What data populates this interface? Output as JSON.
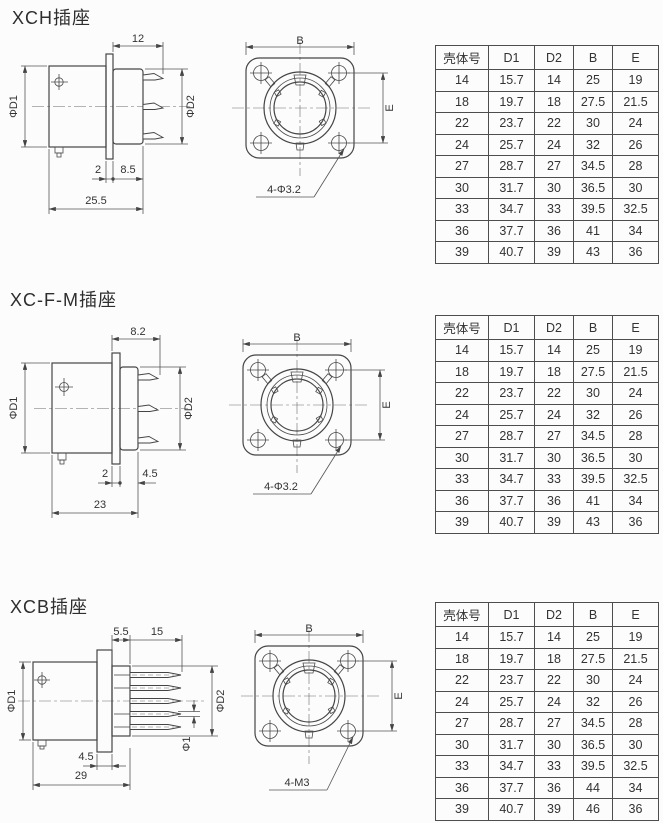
{
  "sections": [
    {
      "title": "XCH插座",
      "side": {
        "top": "12",
        "left": "ΦD1",
        "right": "ΦD2",
        "a": "2",
        "b": "8.5",
        "total": "25.5"
      },
      "front": {
        "width": "B",
        "height": "E",
        "holes": "4-Φ3.2"
      },
      "table": {
        "headers": [
          "壳体号",
          "D1",
          "D2",
          "B",
          "E"
        ],
        "rows": [
          [
            "14",
            "15.7",
            "14",
            "25",
            "19"
          ],
          [
            "18",
            "19.7",
            "18",
            "27.5",
            "21.5"
          ],
          [
            "22",
            "23.7",
            "22",
            "30",
            "24"
          ],
          [
            "24",
            "25.7",
            "24",
            "32",
            "26"
          ],
          [
            "27",
            "28.7",
            "27",
            "34.5",
            "28"
          ],
          [
            "30",
            "31.7",
            "30",
            "36.5",
            "30"
          ],
          [
            "33",
            "34.7",
            "33",
            "39.5",
            "32.5"
          ],
          [
            "36",
            "37.7",
            "36",
            "41",
            "34"
          ],
          [
            "39",
            "40.7",
            "39",
            "43",
            "36"
          ]
        ]
      }
    },
    {
      "title": "XC-F-M插座",
      "side": {
        "top": "8.2",
        "left": "ΦD1",
        "right": "ΦD2",
        "a": "2",
        "b": "4.5",
        "total": "23"
      },
      "front": {
        "width": "B",
        "height": "E",
        "holes": "4-Φ3.2"
      },
      "table": {
        "headers": [
          "壳体号",
          "D1",
          "D2",
          "B",
          "E"
        ],
        "rows": [
          [
            "14",
            "15.7",
            "14",
            "25",
            "19"
          ],
          [
            "18",
            "19.7",
            "18",
            "27.5",
            "21.5"
          ],
          [
            "22",
            "23.7",
            "22",
            "30",
            "24"
          ],
          [
            "24",
            "25.7",
            "24",
            "32",
            "26"
          ],
          [
            "27",
            "28.7",
            "27",
            "34.5",
            "28"
          ],
          [
            "30",
            "31.7",
            "30",
            "36.5",
            "30"
          ],
          [
            "33",
            "34.7",
            "33",
            "39.5",
            "32.5"
          ],
          [
            "36",
            "37.7",
            "36",
            "41",
            "34"
          ],
          [
            "39",
            "40.7",
            "39",
            "43",
            "36"
          ]
        ]
      }
    },
    {
      "title": "XCB插座",
      "side": {
        "top1": "5.5",
        "top2": "15",
        "left": "ΦD1",
        "right": "ΦD2",
        "pin": "Φ1",
        "a": "4.5",
        "total": "29"
      },
      "front": {
        "width": "B",
        "height": "E",
        "holes": "4-M3"
      },
      "table": {
        "headers": [
          "壳体号",
          "D1",
          "D2",
          "B",
          "E"
        ],
        "rows": [
          [
            "14",
            "15.7",
            "14",
            "25",
            "19"
          ],
          [
            "18",
            "19.7",
            "18",
            "27.5",
            "21.5"
          ],
          [
            "22",
            "23.7",
            "22",
            "30",
            "24"
          ],
          [
            "24",
            "25.7",
            "24",
            "32",
            "26"
          ],
          [
            "27",
            "28.7",
            "27",
            "34.5",
            "28"
          ],
          [
            "30",
            "31.7",
            "30",
            "36.5",
            "30"
          ],
          [
            "33",
            "34.7",
            "33",
            "39.5",
            "32.5"
          ],
          [
            "36",
            "37.7",
            "36",
            "44",
            "34"
          ],
          [
            "39",
            "40.7",
            "39",
            "46",
            "36"
          ]
        ]
      }
    }
  ]
}
